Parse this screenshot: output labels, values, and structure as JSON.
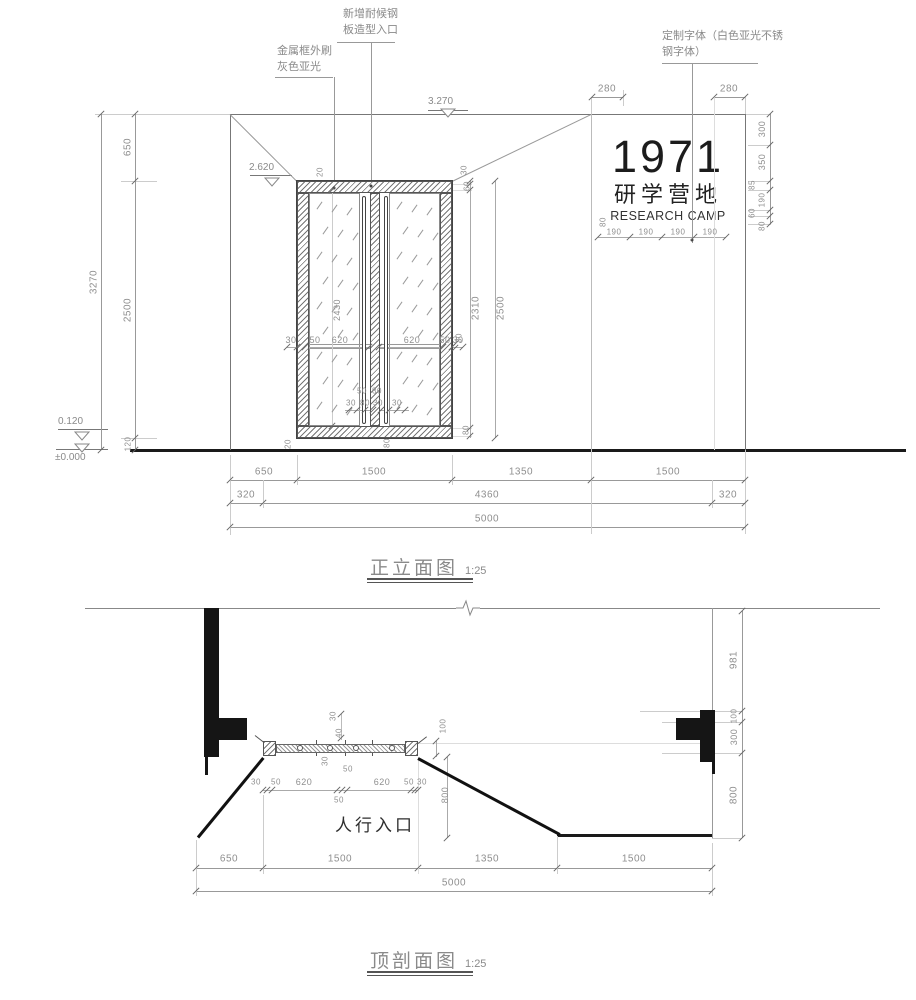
{
  "elevation": {
    "title": "正立面图",
    "scale_label": "1:25",
    "annotation_steel_line1": "新增耐候钢",
    "annotation_steel_line2": "板造型入口",
    "annotation_frame_line1": "金属框外刷",
    "annotation_frame_line2": "灰色亚光",
    "annotation_font_line1": "定制字体（白色亚光不锈",
    "annotation_font_line2": "钢字体）",
    "sign": {
      "line1": "1971",
      "line2": "研学营地",
      "line3": "RESEARCH CAMP"
    },
    "levels": {
      "top": "3.270",
      "door_top": "2.620",
      "sill": "0.120",
      "ground": "±0.000"
    },
    "dims": [
      {
        "t": "280",
        "x": 607,
        "y": 89
      },
      {
        "t": "280",
        "x": 729,
        "y": 89
      },
      {
        "t": "300",
        "x": 762,
        "y": 129,
        "r": 1,
        "s": 9
      },
      {
        "t": "350",
        "x": 762,
        "y": 162,
        "r": 1,
        "s": 9
      },
      {
        "t": "85",
        "x": 752,
        "y": 185,
        "r": 1,
        "s": 8
      },
      {
        "t": "190",
        "x": 762,
        "y": 200,
        "r": 1,
        "s": 8
      },
      {
        "t": "60",
        "x": 752,
        "y": 213,
        "r": 1,
        "s": 8
      },
      {
        "t": "80",
        "x": 762,
        "y": 226,
        "r": 1,
        "s": 8
      },
      {
        "t": "80",
        "x": 603,
        "y": 222,
        "r": 1,
        "s": 8
      },
      {
        "t": "190",
        "x": 614,
        "y": 232,
        "s": 8
      },
      {
        "t": "190",
        "x": 646,
        "y": 232,
        "s": 8
      },
      {
        "t": "190",
        "x": 678,
        "y": 232,
        "s": 8
      },
      {
        "t": "190",
        "x": 710,
        "y": 232,
        "s": 8
      },
      {
        "t": "650",
        "x": 128,
        "y": 147,
        "r": 1
      },
      {
        "t": "2500",
        "x": 128,
        "y": 310,
        "r": 1
      },
      {
        "t": "120",
        "x": 128,
        "y": 444,
        "r": 1,
        "s": 8
      },
      {
        "t": "3270",
        "x": 94,
        "y": 282,
        "r": 1
      },
      {
        "t": "2430",
        "x": 337,
        "y": 310,
        "r": 1,
        "s": 9
      },
      {
        "t": "2310",
        "x": 476,
        "y": 308,
        "r": 1
      },
      {
        "t": "2500",
        "x": 501,
        "y": 308,
        "r": 1
      },
      {
        "t": "30",
        "x": 464,
        "y": 170,
        "r": 1,
        "s": 8
      },
      {
        "t": "60",
        "x": 467,
        "y": 186,
        "r": 1,
        "s": 8
      },
      {
        "t": "30",
        "x": 459,
        "y": 338,
        "r": 1,
        "s": 8
      },
      {
        "t": "80",
        "x": 466,
        "y": 430,
        "r": 1,
        "s": 8
      },
      {
        "t": "20",
        "x": 320,
        "y": 172,
        "r": 1,
        "s": 8
      },
      {
        "t": "20",
        "x": 288,
        "y": 444,
        "r": 1,
        "s": 8
      },
      {
        "t": "80",
        "x": 387,
        "y": 443,
        "r": 1,
        "s": 8
      },
      {
        "t": "30",
        "x": 291,
        "y": 340,
        "s": 9
      },
      {
        "t": "50",
        "x": 315,
        "y": 340,
        "s": 9
      },
      {
        "t": "620",
        "x": 340,
        "y": 340,
        "s": 9
      },
      {
        "t": "620",
        "x": 412,
        "y": 340,
        "s": 9
      },
      {
        "t": "50",
        "x": 445,
        "y": 340,
        "s": 9
      },
      {
        "t": "30",
        "x": 458,
        "y": 340,
        "s": 9
      },
      {
        "t": "50",
        "x": 362,
        "y": 391,
        "s": 8
      },
      {
        "t": "80",
        "x": 377,
        "y": 391,
        "s": 8
      },
      {
        "t": "30",
        "x": 351,
        "y": 403,
        "s": 8
      },
      {
        "t": "80",
        "x": 365,
        "y": 403,
        "s": 8
      },
      {
        "t": "30",
        "x": 378,
        "y": 403,
        "s": 8
      },
      {
        "t": "30",
        "x": 397,
        "y": 403,
        "s": 8
      },
      {
        "t": "650",
        "x": 264,
        "y": 472
      },
      {
        "t": "1500",
        "x": 374,
        "y": 472
      },
      {
        "t": "1350",
        "x": 521,
        "y": 472
      },
      {
        "t": "1500",
        "x": 668,
        "y": 472
      },
      {
        "t": "320",
        "x": 246,
        "y": 495
      },
      {
        "t": "4360",
        "x": 487,
        "y": 495
      },
      {
        "t": "320",
        "x": 728,
        "y": 495
      },
      {
        "t": "5000",
        "x": 487,
        "y": 519
      }
    ]
  },
  "section": {
    "title": "顶剖面图",
    "scale_label": "1:25",
    "entrance_label": "人行入口",
    "dims": [
      {
        "t": "981",
        "x": 734,
        "y": 660,
        "r": 1
      },
      {
        "t": "100",
        "x": 734,
        "y": 716,
        "r": 1,
        "s": 8
      },
      {
        "t": "300",
        "x": 734,
        "y": 737,
        "r": 1,
        "s": 9
      },
      {
        "t": "800",
        "x": 734,
        "y": 795,
        "r": 1
      },
      {
        "t": "100",
        "x": 443,
        "y": 726,
        "r": 1,
        "s": 8
      },
      {
        "t": "30",
        "x": 333,
        "y": 716,
        "r": 1,
        "s": 8
      },
      {
        "t": "40",
        "x": 339,
        "y": 733,
        "r": 1,
        "s": 8
      },
      {
        "t": "30",
        "x": 325,
        "y": 761,
        "r": 1,
        "s": 8
      },
      {
        "t": "800",
        "x": 445,
        "y": 795,
        "r": 1,
        "s": 9
      },
      {
        "t": "30",
        "x": 256,
        "y": 782,
        "s": 8
      },
      {
        "t": "50",
        "x": 276,
        "y": 782,
        "s": 8
      },
      {
        "t": "620",
        "x": 304,
        "y": 782,
        "s": 9
      },
      {
        "t": "50",
        "x": 348,
        "y": 769,
        "s": 8
      },
      {
        "t": "50",
        "x": 339,
        "y": 800,
        "s": 8
      },
      {
        "t": "620",
        "x": 382,
        "y": 782,
        "s": 9
      },
      {
        "t": "50",
        "x": 409,
        "y": 782,
        "s": 8
      },
      {
        "t": "30",
        "x": 422,
        "y": 782,
        "s": 8
      },
      {
        "t": "650",
        "x": 229,
        "y": 859
      },
      {
        "t": "1500",
        "x": 340,
        "y": 859
      },
      {
        "t": "1350",
        "x": 487,
        "y": 859
      },
      {
        "t": "1500",
        "x": 634,
        "y": 859
      },
      {
        "t": "5000",
        "x": 454,
        "y": 883
      }
    ]
  }
}
